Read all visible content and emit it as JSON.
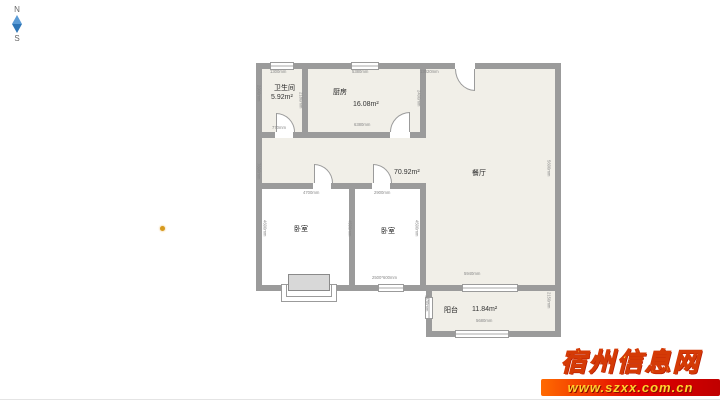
{
  "compass": {
    "north": "N",
    "south": "S"
  },
  "watermark": {
    "title": "宿州信息网",
    "url": "www.szxx.com.cn"
  },
  "floorplan": {
    "colors": {
      "wall": "#9b9b9b",
      "floor": "#f1efe8",
      "bedroom_floor": "#ffffff"
    },
    "labels": [
      {
        "text": "卫生间",
        "x": 18,
        "y": 23,
        "cls": "room"
      },
      {
        "text": "5.92m²",
        "x": 15,
        "y": 34,
        "cls": "area"
      },
      {
        "text": "厨房",
        "x": 77,
        "y": 27,
        "cls": "room"
      },
      {
        "text": "16.08m²",
        "x": 97,
        "y": 41,
        "cls": "area"
      },
      {
        "text": "餐厅",
        "x": 216,
        "y": 108,
        "cls": "room"
      },
      {
        "text": "70.92m²",
        "x": 138,
        "y": 109,
        "cls": "area"
      },
      {
        "text": "卧室",
        "x": 38,
        "y": 164,
        "cls": "room"
      },
      {
        "text": "卧室",
        "x": 125,
        "y": 166,
        "cls": "room"
      },
      {
        "text": "阳台",
        "x": 188,
        "y": 245,
        "cls": "room"
      },
      {
        "text": "11.84m²",
        "x": 216,
        "y": 246,
        "cls": "area"
      }
    ],
    "dimensions": [
      {
        "text": "1300mm",
        "x": 14,
        "y": 10,
        "rot": 0
      },
      {
        "text": "5380mm",
        "x": 96,
        "y": 10,
        "rot": 0
      },
      {
        "text": "13020mm",
        "x": 164,
        "y": 10,
        "rot": 0
      },
      {
        "text": "6380mm",
        "x": 98,
        "y": 63,
        "rot": 0
      },
      {
        "text": "770mm",
        "x": 16,
        "y": 66,
        "rot": 0
      },
      {
        "text": "4700mm",
        "x": 47,
        "y": 131,
        "rot": 0
      },
      {
        "text": "2900mm",
        "x": 118,
        "y": 131,
        "rot": 0
      },
      {
        "text": "2500*600mm",
        "x": 116,
        "y": 216,
        "rot": 0
      },
      {
        "text": "5940mm",
        "x": 208,
        "y": 212,
        "rot": 0
      },
      {
        "text": "5680mm",
        "x": 220,
        "y": 259,
        "rot": 0
      },
      {
        "text": "2900mm",
        "x": 0,
        "y": 25,
        "rot": 90
      },
      {
        "text": "2180mm",
        "x": 42,
        "y": 32,
        "rot": 90
      },
      {
        "text": "2400mm",
        "x": 160,
        "y": 30,
        "rot": 90
      },
      {
        "text": "7600mm",
        "x": 0,
        "y": 103,
        "rot": 90
      },
      {
        "text": "5600mm",
        "x": 290,
        "y": 100,
        "rot": 90
      },
      {
        "text": "4600mm",
        "x": 6,
        "y": 160,
        "rot": 90
      },
      {
        "text": "4500mm",
        "x": 91,
        "y": 160,
        "rot": 90
      },
      {
        "text": "4500mm",
        "x": 158,
        "y": 160,
        "rot": 90
      },
      {
        "text": "1430mm",
        "x": 168,
        "y": 235,
        "rot": 90
      },
      {
        "text": "2150mm",
        "x": 290,
        "y": 232,
        "rot": 90
      }
    ]
  }
}
